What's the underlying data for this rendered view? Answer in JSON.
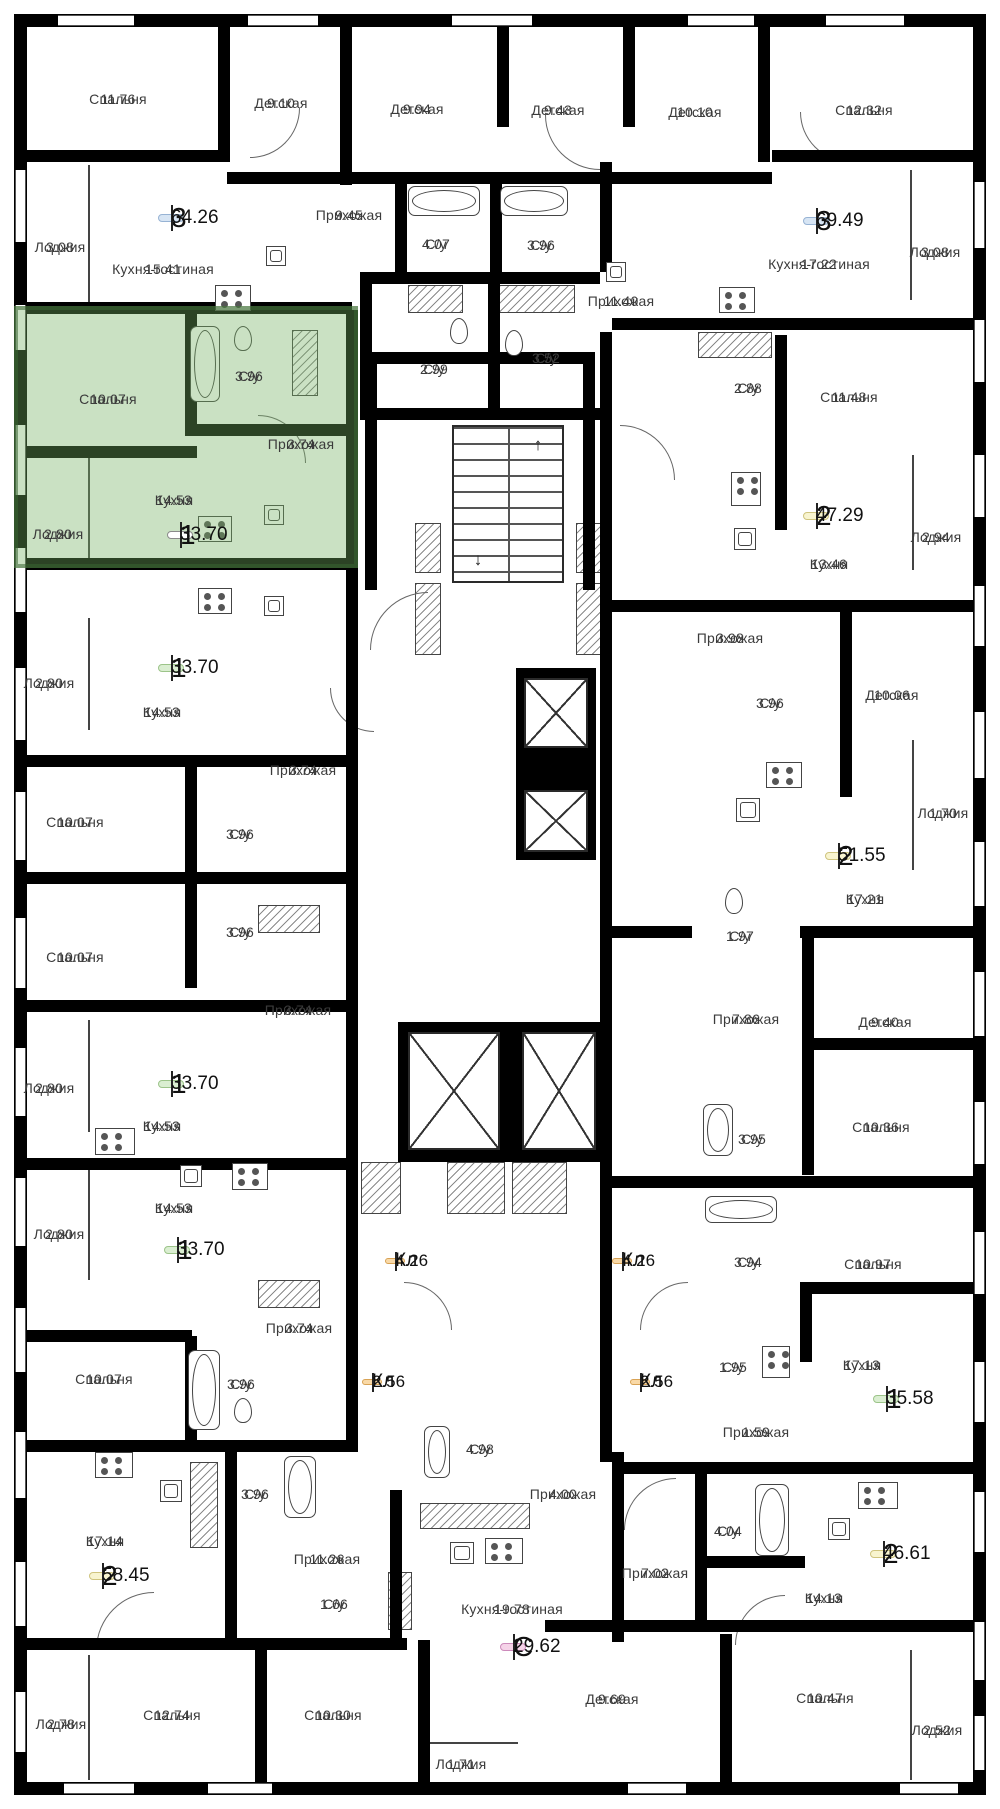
{
  "meta": {
    "kind": "residential-floor-plan",
    "language": "ru"
  },
  "palette": {
    "wall": "#000000",
    "label_text": "#3b3b3b",
    "highlight_fill": "#74af60",
    "highlight_border": "#386432",
    "badge_blue": "#d7e5f4",
    "badge_yellow": "#f8f4cf",
    "badge_green": "#daeed1",
    "badge_orange": "#f9d9a7",
    "badge_pink": "#f5d3e8",
    "badge_highlight": "#ffffff"
  },
  "stairs": {
    "up_arrow": "↑",
    "down_arrow": "↓"
  },
  "highlight": {
    "rooms_label": "1",
    "area": "33.70"
  },
  "rooms": [
    {
      "name": "Спальня",
      "area": "11.76"
    },
    {
      "name": "Детская",
      "area": "9.10"
    },
    {
      "name": "Детская",
      "area": "9.94"
    },
    {
      "name": "Детская",
      "area": "9.43"
    },
    {
      "name": "Детская",
      "area": "10.10"
    },
    {
      "name": "Спальня",
      "area": "12.32"
    },
    {
      "name": "Лоджия",
      "area": "3.08"
    },
    {
      "name": "Кухня-гостиная",
      "area": "15.41"
    },
    {
      "name": "Прихожая",
      "area": "9.45"
    },
    {
      "name": "С/у",
      "area": "4.07"
    },
    {
      "name": "С/у",
      "area": "3.96"
    },
    {
      "name": "Прихожая",
      "area": "11.40"
    },
    {
      "name": "Кухня-гостиная",
      "area": "17.22"
    },
    {
      "name": "Лоджия",
      "area": "3.08"
    },
    {
      "name": "Спальня",
      "area": "10.07"
    },
    {
      "name": "С/у",
      "area": "3.96"
    },
    {
      "name": "С/у",
      "area": "2.99"
    },
    {
      "name": "С/у",
      "area": "3.52"
    },
    {
      "name": "С/у",
      "area": "2.88"
    },
    {
      "name": "Спальня",
      "area": "11.48"
    },
    {
      "name": "Прихожая",
      "area": "3.74"
    },
    {
      "name": "Кухня",
      "area": "14.53"
    },
    {
      "name": "Лоджия",
      "area": "2.80"
    },
    {
      "name": "Кухня",
      "area": "13.46"
    },
    {
      "name": "Лоджия",
      "area": "2.94"
    },
    {
      "name": "Лоджия",
      "area": "2.80"
    },
    {
      "name": "Кухня",
      "area": "14.53"
    },
    {
      "name": "Прихожая",
      "area": "3.98"
    },
    {
      "name": "Детская",
      "area": "10.06"
    },
    {
      "name": "С/у",
      "area": "3.96"
    },
    {
      "name": "Прихожая",
      "area": "3.74"
    },
    {
      "name": "Спальня",
      "area": "10.07"
    },
    {
      "name": "С/у",
      "area": "3.96"
    },
    {
      "name": "Лоджия",
      "area": "1.70"
    },
    {
      "name": "Кухня",
      "area": "17.21"
    },
    {
      "name": "С/у",
      "area": "3.96"
    },
    {
      "name": "Спальня",
      "area": "10.07"
    },
    {
      "name": "С/у",
      "area": "1.97"
    },
    {
      "name": "Прихожая",
      "area": "3.74"
    },
    {
      "name": "Прихожая",
      "area": "7.86"
    },
    {
      "name": "Детская",
      "area": "9.40"
    },
    {
      "name": "Лоджия",
      "area": "2.80"
    },
    {
      "name": "Кухня",
      "area": "14.53"
    },
    {
      "name": "С/у",
      "area": "3.95"
    },
    {
      "name": "Спальня",
      "area": "10.36"
    },
    {
      "name": "Кухня",
      "area": "14.53"
    },
    {
      "name": "Лоджия",
      "area": "2.80"
    },
    {
      "name": "С/у",
      "area": "3.94"
    },
    {
      "name": "Спальня",
      "area": "10.97"
    },
    {
      "name": "Прихожая",
      "area": "3.74"
    },
    {
      "name": "Спальня",
      "area": "10.07"
    },
    {
      "name": "С/у",
      "area": "3.96"
    },
    {
      "name": "С/у",
      "area": "1.95"
    },
    {
      "name": "Кухня",
      "area": "17.13"
    },
    {
      "name": "Прихожая",
      "area": "1.59"
    },
    {
      "name": "С/у",
      "area": "4.98"
    },
    {
      "name": "С/у",
      "area": "3.96"
    },
    {
      "name": "Прихожая",
      "area": "4.00"
    },
    {
      "name": "Кухня",
      "area": "17.14"
    },
    {
      "name": "Прихожая",
      "area": "11.26"
    },
    {
      "name": "С/у",
      "area": "4.04"
    },
    {
      "name": "Прихожая",
      "area": "7.02"
    },
    {
      "name": "С/у",
      "area": "1.66"
    },
    {
      "name": "Кухня-гостиная",
      "area": "19.78"
    },
    {
      "name": "Кухня",
      "area": "14.13"
    },
    {
      "name": "Лоджия",
      "area": "2.78"
    },
    {
      "name": "Спальня",
      "area": "12.74"
    },
    {
      "name": "Спальня",
      "area": "10.30"
    },
    {
      "name": "Лоджия",
      "area": "1.71"
    },
    {
      "name": "Детская",
      "area": "9.69"
    },
    {
      "name": "Спальня",
      "area": "10.47"
    },
    {
      "name": "Лоджия",
      "area": "2.52"
    }
  ],
  "badges": [
    {
      "label": "3",
      "area": "64.26",
      "color": "blue"
    },
    {
      "label": "3",
      "area": "69.49",
      "color": "blue"
    },
    {
      "label": "1",
      "area": "33.70",
      "color": "highlight"
    },
    {
      "label": "2",
      "area": "47.29",
      "color": "yellow"
    },
    {
      "label": "1",
      "area": "33.70",
      "color": "green"
    },
    {
      "label": "2",
      "area": "51.55",
      "color": "yellow"
    },
    {
      "label": "1",
      "area": "33.70",
      "color": "green"
    },
    {
      "label": "1",
      "area": "33.70",
      "color": "green"
    },
    {
      "label": "Кл",
      "area": "4.26",
      "color": "orange"
    },
    {
      "label": "Кл",
      "area": "4.26",
      "color": "orange"
    },
    {
      "label": "Кл",
      "area": "2.56",
      "color": "orange"
    },
    {
      "label": "Кл",
      "area": "2.56",
      "color": "orange"
    },
    {
      "label": "1",
      "area": "35.58",
      "color": "green"
    },
    {
      "label": "2",
      "area": "58.45",
      "color": "yellow"
    },
    {
      "label": "С",
      "area": "29.62",
      "color": "pink"
    },
    {
      "label": "2",
      "area": "46.61",
      "color": "yellow"
    }
  ]
}
